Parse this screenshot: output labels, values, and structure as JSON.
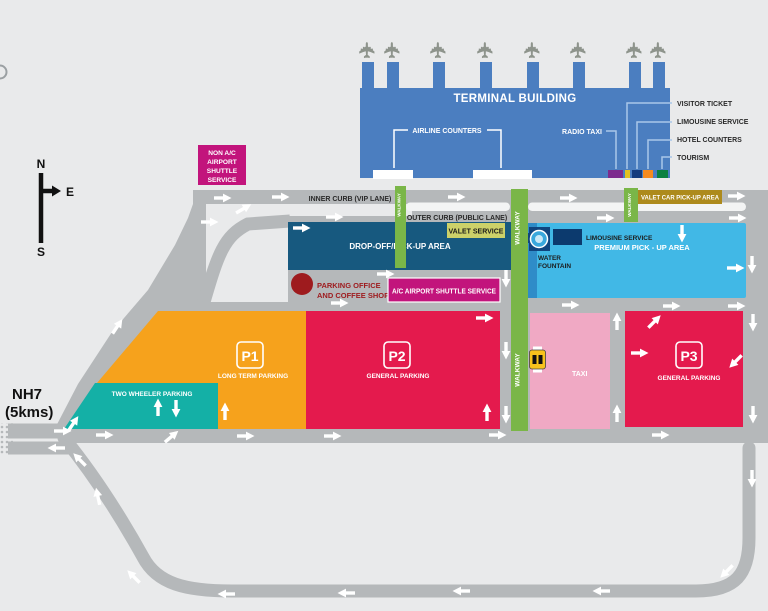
{
  "colors": {
    "background": "#e9eaeb",
    "road": "#b5b8ba",
    "lane_stripe": "#f3f4f4",
    "terminal_blue": "#4b7ec0",
    "dropoff_blue": "#17597f",
    "premium_blue": "#41b8e6",
    "premium_accent": "#2f8cc8",
    "fountain_navy": "#10457e",
    "limo_navy": "#0c3a6e",
    "walkway_green": "#7ab648",
    "valet_olive": "#ccd169",
    "valet_gold": "#ad8a1c",
    "magenta": "#c2147c",
    "p1_orange": "#f6a21c",
    "p_crimson": "#e41a4d",
    "two_wheeler_teal": "#14b0a6",
    "taxi_pink": "#f0a9c4",
    "office_red": "#9e1b1e",
    "legend_purple": "#7d2b8d",
    "legend_yellow": "#e3c121",
    "legend_navy": "#143c7d",
    "legend_orange": "#f68b1f",
    "legend_green": "#0b8040"
  },
  "compass": {
    "north": "N",
    "east": "E",
    "south": "S"
  },
  "highway": {
    "name": "NH7",
    "distance": "(5kms)"
  },
  "terminal": {
    "title": "TERMINAL BUILDING",
    "airline_counters": "AIRLINE COUNTERS",
    "radio_taxi": "RADIO TAXI",
    "legend": {
      "visitor_ticket": "VISITOR TICKET",
      "limousine_service": "LIMOUSINE SERVICE",
      "hotel_counters": "HOTEL COUNTERS",
      "tourism": "TOURISM"
    }
  },
  "curbs": {
    "inner": "INNER CURB (VIP LANE)",
    "outer": "OUTER CURB (PUBLIC LANE)",
    "walkway": "WALKWAY"
  },
  "services": {
    "non_ac_shuttle": {
      "line1": "NON A/C",
      "line2": "AIRPORT",
      "line3": "SHUTTLE",
      "line4": "SERVICE"
    },
    "ac_shuttle": "A/C AIRPORT SHUTTLE SERVICE",
    "valet_service": "VALET SERVICE",
    "valet_car_pickup": "VALET CAR PICK-UP AREA",
    "limousine": "LIMOUSINE SERVICE",
    "water_fountain": {
      "line1": "WATER",
      "line2": "FOUNTAIN"
    },
    "parking_office": {
      "line1": "PARKING OFFICE",
      "line2": "AND COFFEE SHOP"
    }
  },
  "areas": {
    "dropoff": "DROP-OFF/PICK-UP AREA",
    "premium": "PREMIUM PICK - UP AREA",
    "taxi": "TAXI",
    "p1": {
      "code": "P1",
      "label": "LONG TERM PARKING"
    },
    "p2": {
      "code": "P2",
      "label": "GENERAL PARKING"
    },
    "p3": {
      "code": "P3",
      "label": "GENERAL PARKING"
    },
    "two_wheeler": "TWO WHEELER PARKING"
  }
}
